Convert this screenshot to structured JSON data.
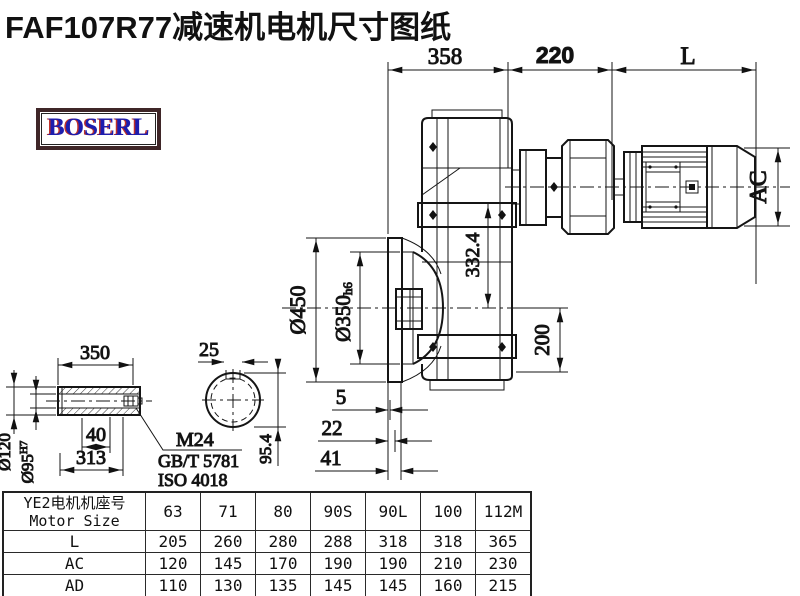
{
  "title": "FAF107R77减速机电机尺寸图纸",
  "logo": {
    "text": "BOSERL"
  },
  "drawing": {
    "dims": {
      "gear_width": "358",
      "adapter_width": "220",
      "motor_length": "L",
      "motor_diameter": "AC",
      "flange_diameter": "Ø450",
      "spigot_diameter": "Ø350",
      "spigot_tolerance": "h6",
      "shaft_height": "332.4",
      "base_height": "200",
      "flange_step_1": "5",
      "flange_step_2": "22",
      "flange_step_3": "41"
    },
    "shaft_detail": {
      "length": "350",
      "key_width": "25",
      "bolt_depth": "40",
      "bore_length": "313",
      "outer_diameter": "Ø120",
      "bore_diameter": "Ø95",
      "bore_tolerance": "H7",
      "key_height": "95.4",
      "bolt_label": "M24",
      "bolt_standard_1": "GB/T 5781",
      "bolt_standard_2": "ISO 4018"
    }
  },
  "table": {
    "header_line1": "YE2电机机座号",
    "header_line2": "Motor Size",
    "sizes": [
      "63",
      "71",
      "80",
      "90S",
      "90L",
      "100",
      "112M"
    ],
    "rows": [
      {
        "label": "L",
        "values": [
          "205",
          "260",
          "280",
          "288",
          "318",
          "318",
          "365"
        ]
      },
      {
        "label": "AC",
        "values": [
          "120",
          "145",
          "170",
          "190",
          "190",
          "210",
          "230"
        ]
      },
      {
        "label": "AD",
        "values": [
          "110",
          "130",
          "135",
          "145",
          "145",
          "160",
          "215"
        ]
      }
    ]
  }
}
